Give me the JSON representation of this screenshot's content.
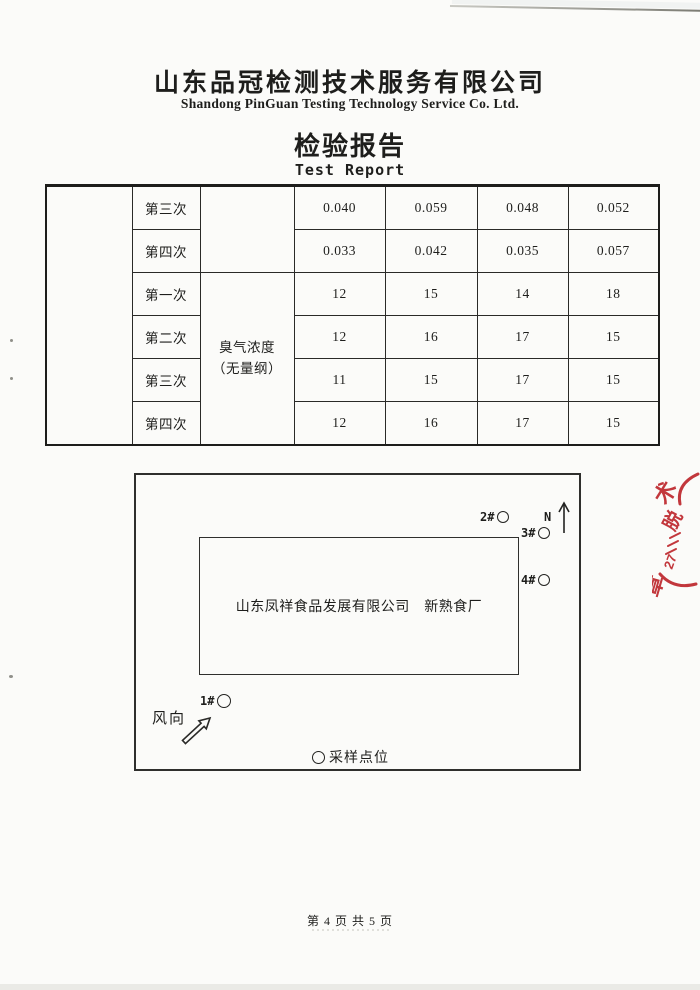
{
  "header": {
    "company_cn": "山东品冠检测技术服务有限公司",
    "company_en": "Shandong PinGuan Testing Technology Service Co. Ltd.",
    "title_cn": "检验报告",
    "title_en": "Test Report"
  },
  "table": {
    "param": {
      "line1": "臭气浓度",
      "line2": "（无量纲）"
    },
    "rows": [
      {
        "label": "第三次",
        "values": [
          "0.040",
          "0.059",
          "0.048",
          "0.052"
        ]
      },
      {
        "label": "第四次",
        "values": [
          "0.033",
          "0.042",
          "0.035",
          "0.057"
        ]
      },
      {
        "label": "第一次",
        "values": [
          "12",
          "15",
          "14",
          "18"
        ]
      },
      {
        "label": "第二次",
        "values": [
          "12",
          "16",
          "17",
          "15"
        ]
      },
      {
        "label": "第三次",
        "values": [
          "11",
          "15",
          "17",
          "15"
        ]
      },
      {
        "label": "第四次",
        "values": [
          "12",
          "16",
          "17",
          "15"
        ]
      }
    ]
  },
  "diagram": {
    "facility_label": "山东凤祥食品发展有限公司　新熟食厂",
    "north_label": "N",
    "wind_label": "风向",
    "legend_label": "采样点位",
    "points": {
      "p1": "1#",
      "p2": "2#",
      "p3": "3#",
      "p4": "4#"
    }
  },
  "stamp": {
    "color": "#c2373c",
    "glyph_top": "术",
    "glyph_mid": "脱",
    "glyph_num": "27",
    "glyph_bottom": "章"
  },
  "footer": {
    "page_info": "第 4 页 共 5 页"
  }
}
